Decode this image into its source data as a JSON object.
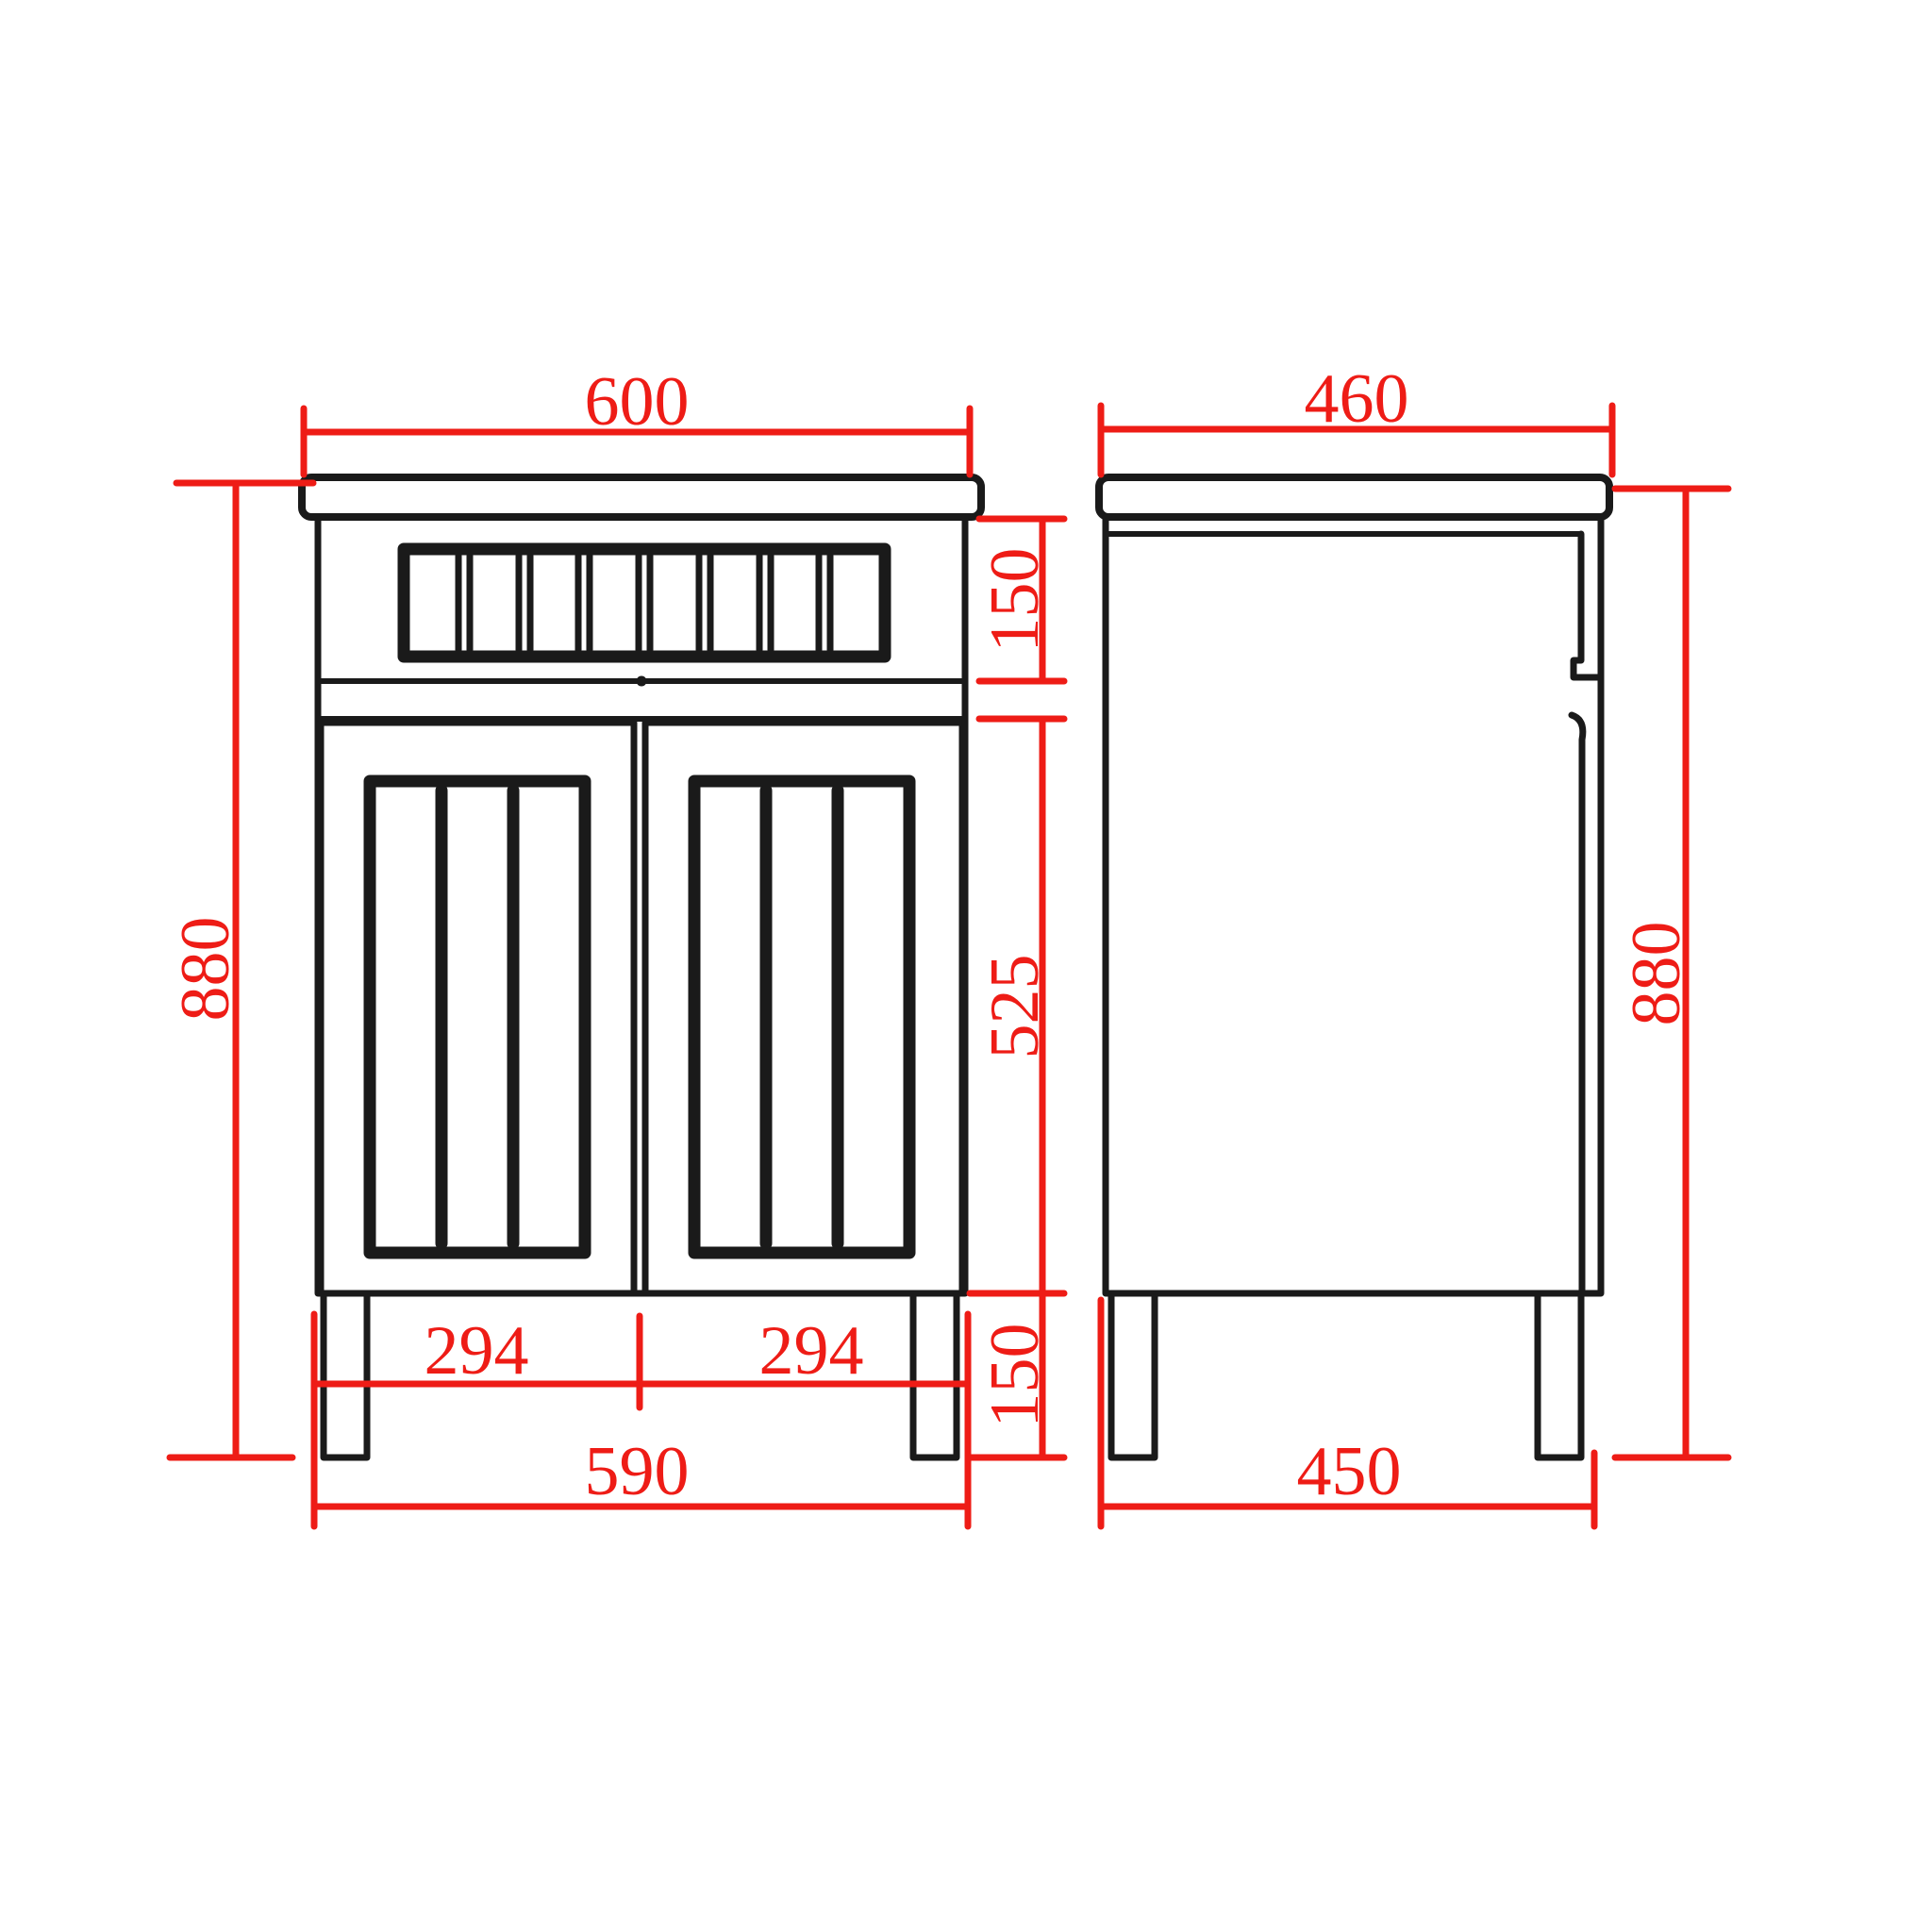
{
  "colors": {
    "dimension": "#ee1c16",
    "line": "#1a1a1a",
    "background": "#ffffff"
  },
  "front_view": {
    "width_top": "600",
    "height_left": "880",
    "drawer_height": "150",
    "doors_height": "525",
    "legs_height": "150",
    "door_width_left": "294",
    "door_width_right": "294",
    "base_width": "590"
  },
  "side_view": {
    "depth_top": "460",
    "height_right": "880",
    "base_depth": "450"
  }
}
